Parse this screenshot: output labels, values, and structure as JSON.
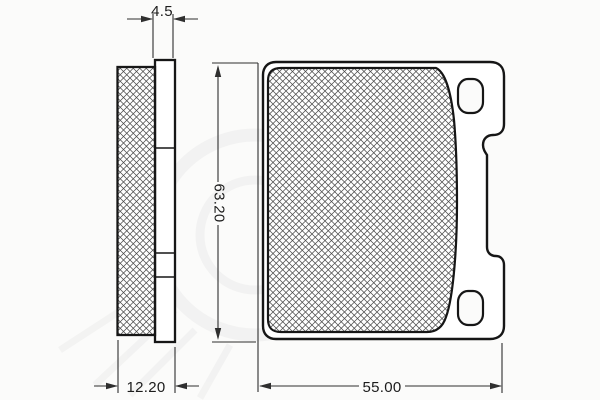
{
  "dimensions": {
    "backplate_thickness": "4.5",
    "total_thickness": "12.20",
    "pad_height": "63.20",
    "pad_width": "55.00"
  },
  "colors": {
    "outline": "#161616",
    "dimension_line": "#2f2f2f",
    "hatch": "#4a4a4a",
    "background": "#fbfbfa",
    "watermark": "#8f8f8f"
  }
}
